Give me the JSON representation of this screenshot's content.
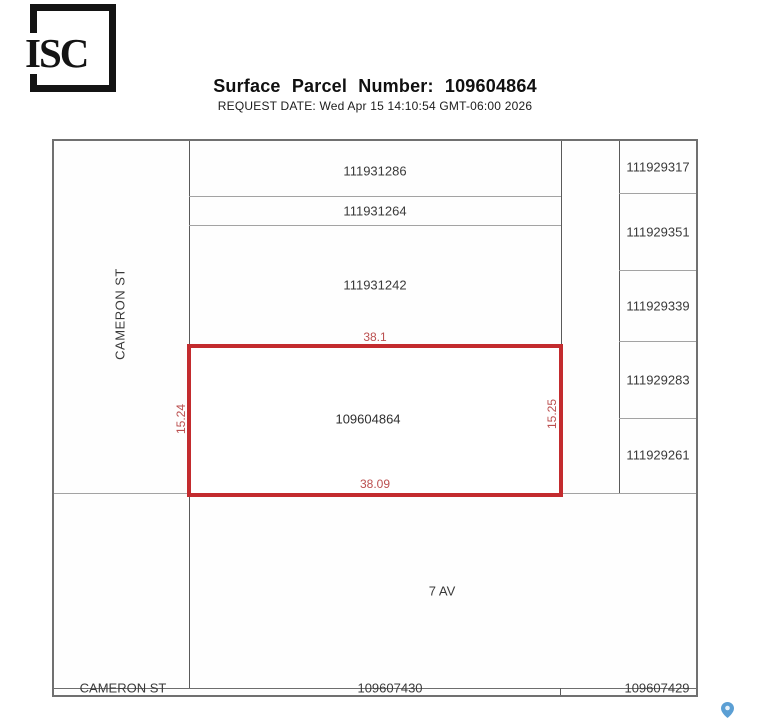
{
  "header": {
    "logo_text": "ISC",
    "title": "Surface Parcel Number: 109604864",
    "request_date": "REQUEST DATE: Wed Apr 15 14:10:54 GMT-06:00 2026"
  },
  "map": {
    "street_left_vertical": "CAMERON ST",
    "street_bottom": "CAMERON ST",
    "avenue": "7 AV",
    "subject_parcel": {
      "number": "109604864",
      "dim_top": "38.1",
      "dim_bottom": "38.09",
      "dim_left": "15.24",
      "dim_right": "15.25"
    },
    "north_parcels": [
      "111931286",
      "111931264",
      "111931242"
    ],
    "east_parcels": [
      "111929317",
      "111929351",
      "111929339",
      "111929283",
      "111929261"
    ],
    "south_parcels": [
      "109607430",
      "109607429"
    ],
    "icons": {
      "pin": "map-pin"
    },
    "colors": {
      "subject_outline": "#c32b2e",
      "dimension_text": "#bb4f4f",
      "map_border": "#707070",
      "boundary_dark": "#5a5a5a",
      "boundary_light": "#a3a3a3",
      "pin_blue": "#5b9fd4"
    }
  }
}
